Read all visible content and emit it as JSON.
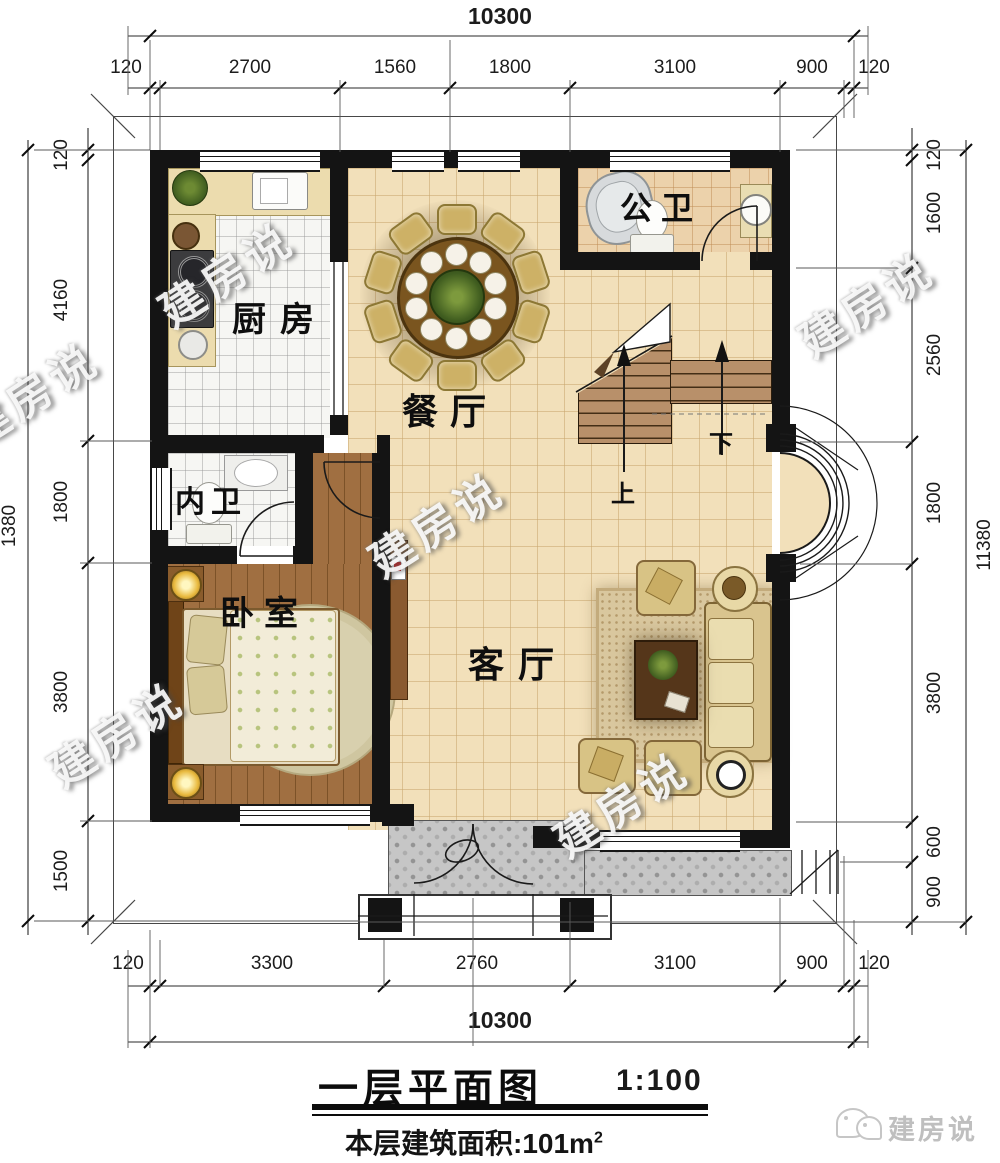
{
  "title_block": {
    "title": "一层平面图",
    "scale": "1:100",
    "area_label": "本层建筑面积:101m",
    "area_sup": "2"
  },
  "brand": {
    "name": "建房说"
  },
  "watermark": "建房说",
  "rooms": {
    "kitchen": "厨房",
    "public_bath": "公卫",
    "dining": "餐厅",
    "inner_bath": "内卫",
    "bedroom": "卧室",
    "living": "客厅"
  },
  "stairs": {
    "up_label": "上",
    "down_label": "下"
  },
  "dimensions": {
    "top": {
      "total": "10300",
      "segments": [
        "120",
        "2700",
        "1560",
        "1800",
        "3100",
        "900",
        "120"
      ]
    },
    "bottom": {
      "total": "10300",
      "segments": [
        "120",
        "3300",
        "2760",
        "3100",
        "900",
        "120"
      ]
    },
    "left": {
      "total": "1380",
      "segments": [
        "120",
        "4160",
        "1800",
        "3800",
        "1500"
      ]
    },
    "right": {
      "total": "11380",
      "segments": [
        "120",
        "1600",
        "2560",
        "1800",
        "3800",
        "600",
        "900"
      ]
    }
  },
  "colors": {
    "wall": "#141414",
    "tile_main": "#f2e0ba",
    "tile_bath": "#ecd2ab",
    "tile_white": "#f6f6f3",
    "wood": "#9a6a3e",
    "counter": "#ecdcae",
    "stair": "#b8906a",
    "porch": "#c6c6c6",
    "table": "#7a551f",
    "sofa": "#e3d2a2",
    "watermark_gray": "#bfbfbf"
  }
}
